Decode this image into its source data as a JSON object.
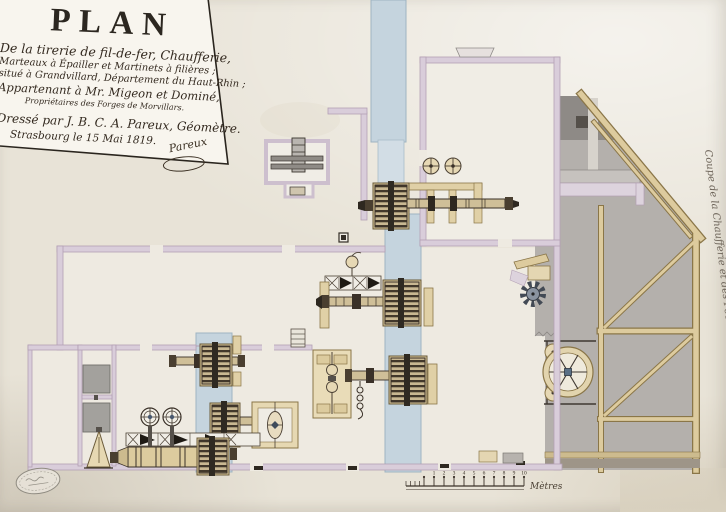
{
  "title_block": {
    "title": "PLAN",
    "subtitle_lines": [
      "De la tirerie de fil-de-fer, Chaufferie,",
      "Marteaux à Épailler et Martinets à filières ;",
      "situé à Grandvillard, Département du Haut-Rhin ;",
      "Appartenant à Mr. Migeon et Dominé,",
      "Propriétaires des Forges de Morvillars."
    ],
    "credit_line": "Dressé par J. B. C. A. Pareux, Géomètre.",
    "date_line": "Strasbourg le 15 Mai 1819.",
    "signature": "Pareux"
  },
  "section_view": {
    "label": "Coupe de la Chaufferie et des Poêlons."
  },
  "scale_bar": {
    "tick_labels": [
      "1",
      "2",
      "3",
      "4",
      "5",
      "6",
      "7",
      "8",
      "9",
      "10"
    ],
    "unit_label": "Mètres"
  },
  "palette": {
    "paper": "#e8e3d7",
    "title_sheet": "#f8f5ee",
    "ink": "#2f2a22",
    "channel_blue": "#c5d4de",
    "wall_lilac": "#d9cdda",
    "wood_tan": "#ddcb9e",
    "machine_dark": "#3a3128",
    "section_gray": "#b4b0ac",
    "hub_blue": "#5a7086"
  }
}
